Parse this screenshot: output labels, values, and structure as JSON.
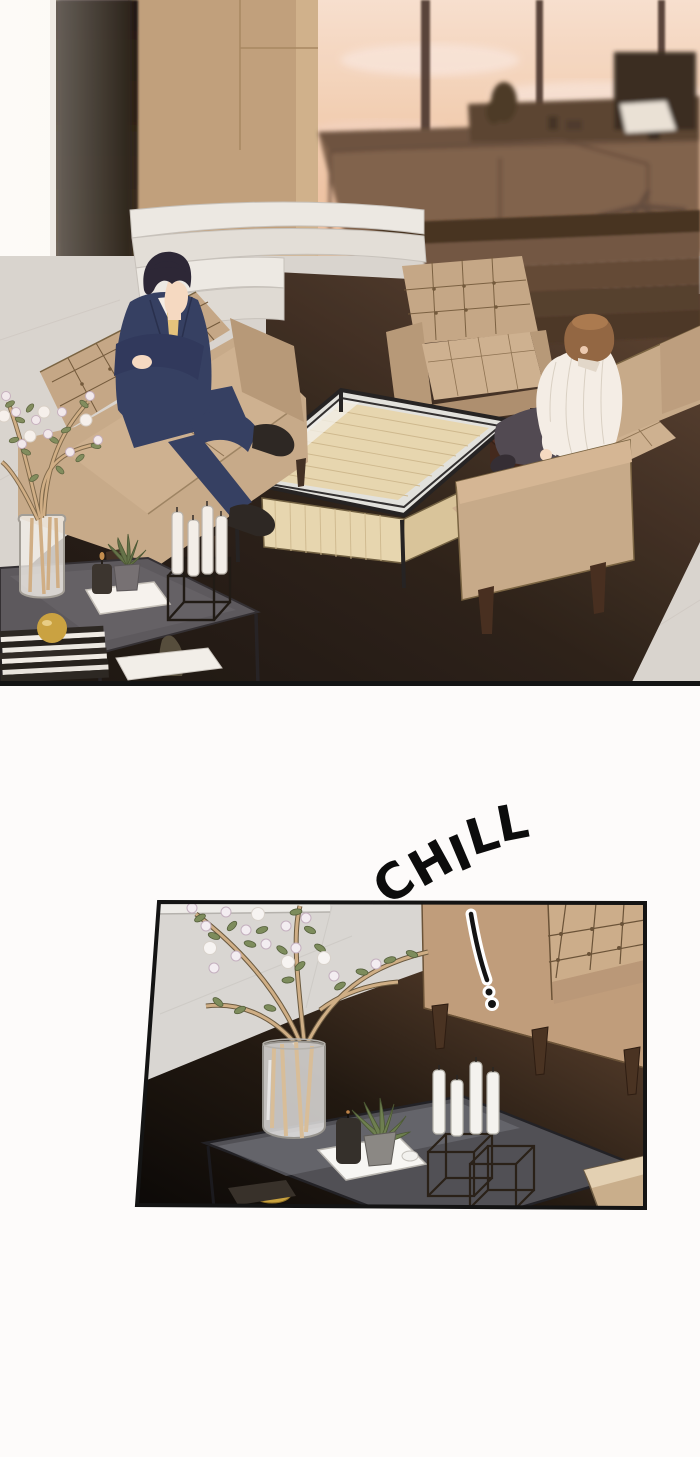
{
  "page": {
    "width": 700,
    "height": 1457
  },
  "sfx": {
    "shout": "CHILL",
    "effect_mark": "!"
  },
  "panels": [
    {
      "id": "panel-1",
      "shape": "full-bleed",
      "content": "sunset office lounge, two men seated on tufted beige sofas around a glass coffee table"
    },
    {
      "id": "panel-2",
      "shape": "tilted-frame",
      "content": "close-up of blossom branches in a glass vase, candles and tray on a dark side table beside a sofa"
    }
  ],
  "palette": {
    "page-bg": "#fdfbfa",
    "ink": "#141414",
    "sky-top": "#f8e2d2",
    "sky-bottom": "#ecbd9c",
    "mullion": "#44322a",
    "wall": "#bfa07c",
    "pillar": "#1c130d",
    "marble": "#d9d6d2",
    "step-white": "#edebe7",
    "step-brown": "#6d5340",
    "carpet-dark": "#17110d",
    "carpet-warm": "#5d4430",
    "sofa": "#c6aa8a",
    "sofa-seat": "#cdb191",
    "sofa-line": "#74603f",
    "suit": "#2d3a60",
    "tie": "#e5c57c",
    "skin": "#f6dcc5",
    "hair-dark": "#232032",
    "hair-brown": "#8f6440",
    "shirt": "#f5f1ea",
    "pants": "#4a4550",
    "glass": "#e2e4e1",
    "wood": "#e7d8b2",
    "metal": "#1c1c1e",
    "side-table": "#56555b",
    "brass": "#c9a23e",
    "candle": "#f4f2ee",
    "leaf": "#7d8c5c",
    "blossom": "#f3edf1",
    "stem": "#cfae85",
    "tray": "#f7f6f3",
    "couch2": "#c09d7b",
    "table2": "#515055"
  }
}
